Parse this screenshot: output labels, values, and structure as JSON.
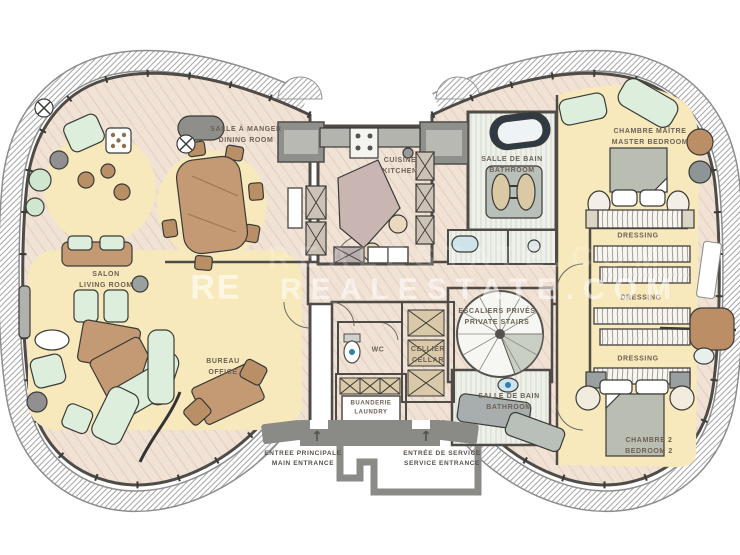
{
  "palette": {
    "wall": "#4f4c48",
    "wood_floor": "#f1e2d6",
    "rug_yellow": "#f7e9bb",
    "furniture_mint": "#ddeedd",
    "furniture_brown": "#c49a74",
    "structure_gray": "#8a8a86",
    "label_text": "#6d6156",
    "accent_blue": "#2e7fb0"
  },
  "rooms": [
    {
      "id": "dining",
      "fr": "SALLE À MANGER",
      "en": "DINING ROOM"
    },
    {
      "id": "kitchen",
      "fr": "CUISINE",
      "en": "KITCHEN"
    },
    {
      "id": "bathroom-top",
      "fr": "SALLE DE BAIN",
      "en": "BATHROOM"
    },
    {
      "id": "master",
      "fr": "CHAMBRE MAÎTRE",
      "en": "MASTER BEDROOM"
    },
    {
      "id": "living",
      "fr": "SALON",
      "en": "LIVING ROOM"
    },
    {
      "id": "office",
      "fr": "BUREAU",
      "en": "OFFICE"
    },
    {
      "id": "wc",
      "fr": "WC",
      "en": ""
    },
    {
      "id": "cellar",
      "fr": "CELLIER",
      "en": "CELLAR"
    },
    {
      "id": "stairs",
      "fr": "ESCALIERS PRIVÉS",
      "en": "PRIVATE STAIRS"
    },
    {
      "id": "laundry",
      "fr": "BUANDERIE",
      "en": "LAUNDRY"
    },
    {
      "id": "bathroom-bot",
      "fr": "SALLE DE BAIN",
      "en": "BATHROOM"
    },
    {
      "id": "dressing-1",
      "fr": "DRESSING",
      "en": ""
    },
    {
      "id": "dressing-2",
      "fr": "DRESSING",
      "en": ""
    },
    {
      "id": "dressing-3",
      "fr": "DRESSING",
      "en": ""
    },
    {
      "id": "bedroom2",
      "fr": "CHAMBRE 2",
      "en": "BEDROOM 2"
    }
  ],
  "entrances": [
    {
      "id": "main",
      "fr": "ENTREE PRINCIPALE",
      "en": "MAIN ENTRANCE",
      "arrow": "↑"
    },
    {
      "id": "service",
      "fr": "ENTRÉE DE SERVICE",
      "en": "SERVICE ENTRANCE",
      "arrow": "↑"
    }
  ],
  "watermark": {
    "logo": "RE",
    "text": "REALESTATE.COM"
  }
}
